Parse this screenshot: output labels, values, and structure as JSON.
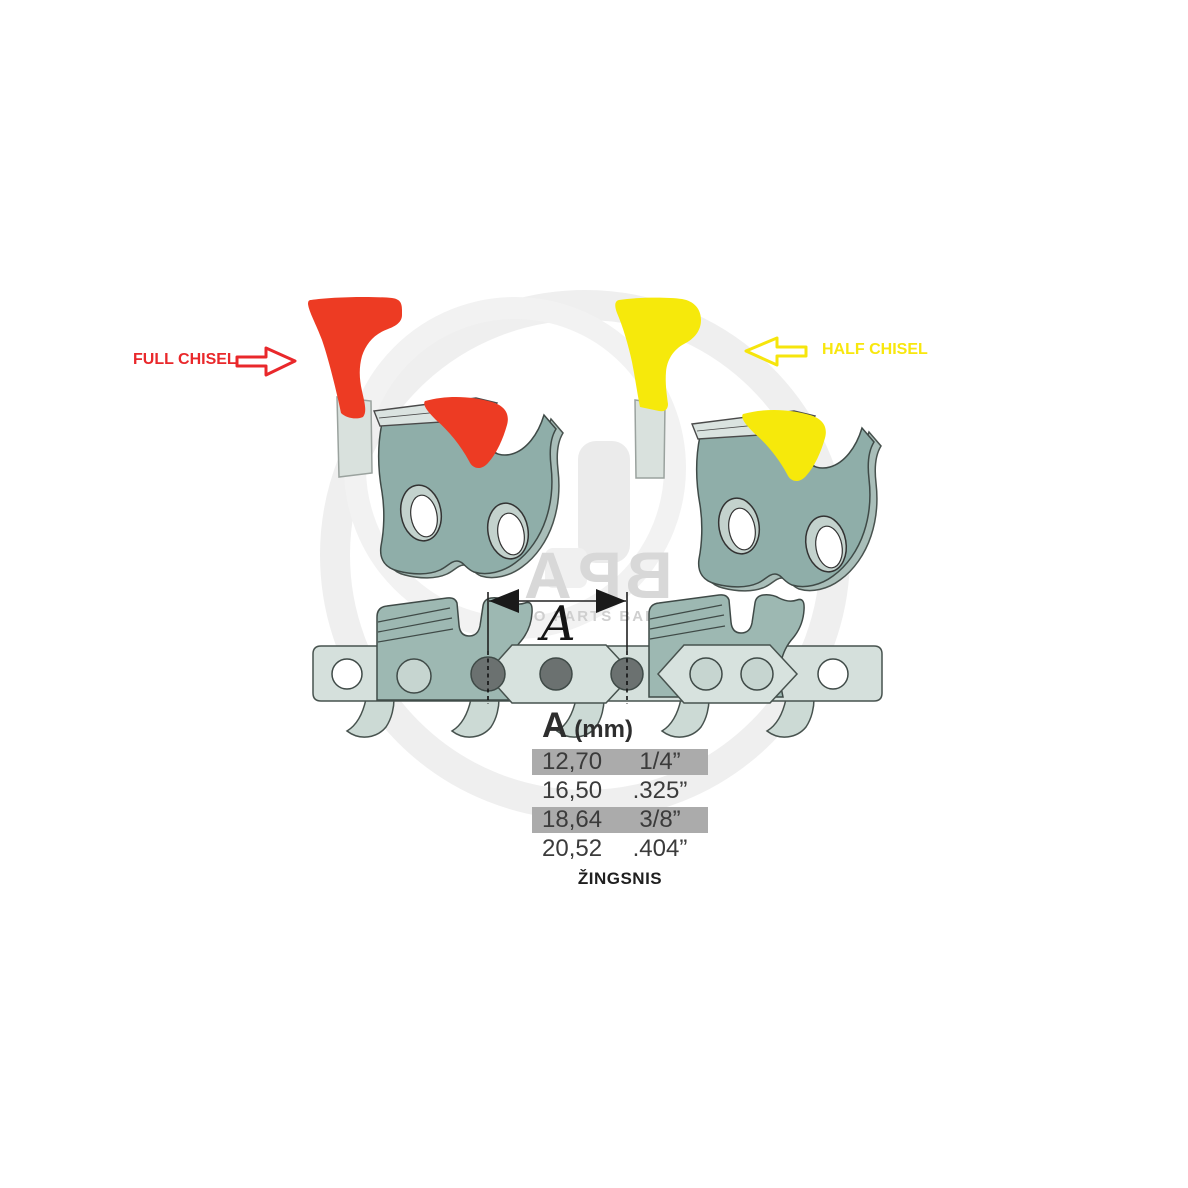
{
  "illustration": {
    "full_chisel_label": "FULL CHISEL",
    "half_chisel_label": "HALF CHISEL",
    "dimension_label": "A"
  },
  "watermark": {
    "logo_letters": [
      "A",
      "P",
      "B"
    ],
    "subtitle": "AGRO PARTS BALTIJA"
  },
  "pitch_table": {
    "header": {
      "letter": "A",
      "unit": "(mm)"
    },
    "rows": [
      {
        "mm": "12,70",
        "inch": "1/4”",
        "highlighted": true
      },
      {
        "mm": "16,50",
        "inch": ".325”",
        "highlighted": false
      },
      {
        "mm": "18,64",
        "inch": "3/8”",
        "highlighted": true
      },
      {
        "mm": "20,52",
        "inch": ".404”",
        "highlighted": false
      }
    ],
    "caption": "ŽINGSNIS"
  },
  "colors": {
    "full_chisel_red": "#ED3B23",
    "half_chisel_yellow": "#F6E90B",
    "link_teal": "#8FAEA9",
    "overlay_teal": "#9DB8B2",
    "strap_light": "#D5E0DC",
    "rivet_gray": "#6B7170",
    "row_highlight": "#ABABAB"
  }
}
